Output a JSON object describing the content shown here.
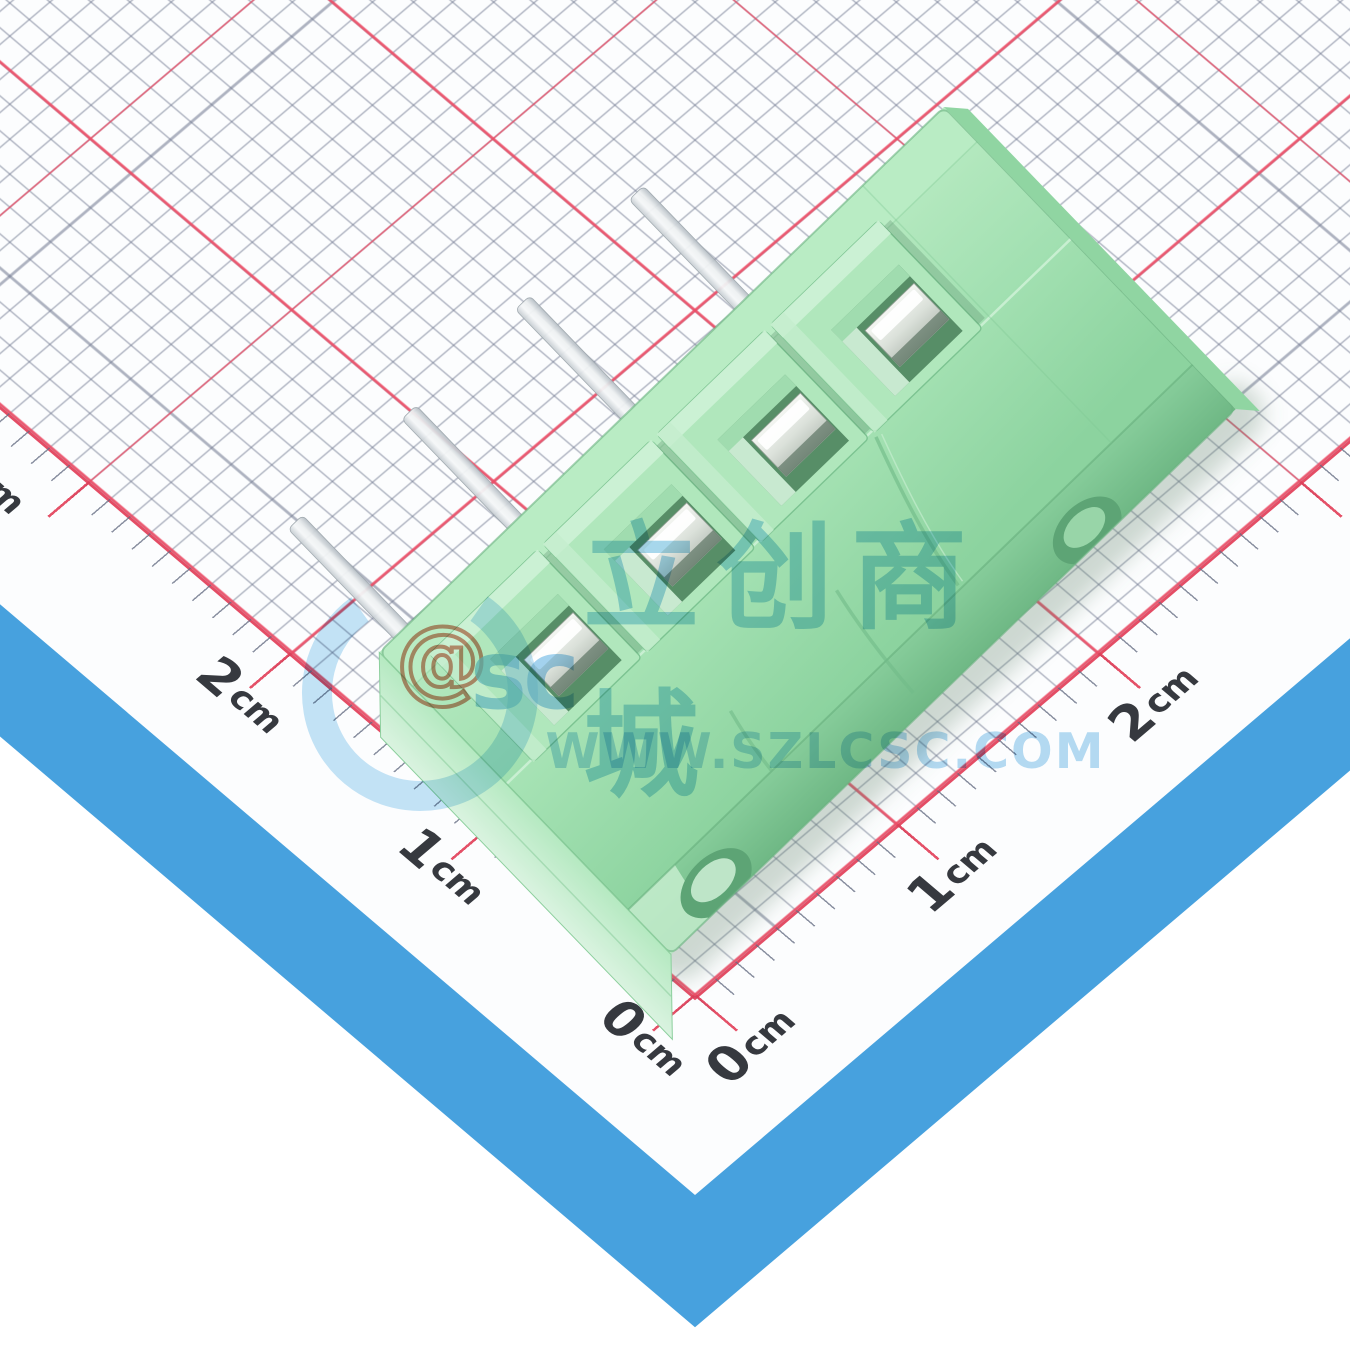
{
  "ruler": {
    "unit": "cm",
    "left_labels": [
      {
        "num": "0",
        "unit": "cm"
      },
      {
        "num": "1",
        "unit": "cm"
      },
      {
        "num": "2",
        "unit": "cm"
      },
      {
        "num": "3",
        "unit": "cm"
      }
    ],
    "right_labels": [
      {
        "num": "0",
        "unit": "cm"
      },
      {
        "num": "1",
        "unit": "cm"
      },
      {
        "num": "2",
        "unit": "cm"
      }
    ]
  },
  "watermark": {
    "logo_at": "@",
    "logo_text": "sc",
    "title": "立创商城",
    "subtitle": "WWW.SZLCSC.COM"
  },
  "component": {
    "name": "green screw terminal block",
    "positions": 4,
    "pins": 4
  },
  "colors": {
    "mat_blue": "#47a1de",
    "grid_red": "#ec4d66",
    "grid_minor_gray": "#6e768e",
    "paper_white": "#fcfdfe",
    "label_text": "#36393f",
    "body_green": "#9adcab",
    "metal_silver": "#d9dfd9",
    "watermark_blue": "#92cee9",
    "watermark_at_salmon": "#d2765c"
  }
}
